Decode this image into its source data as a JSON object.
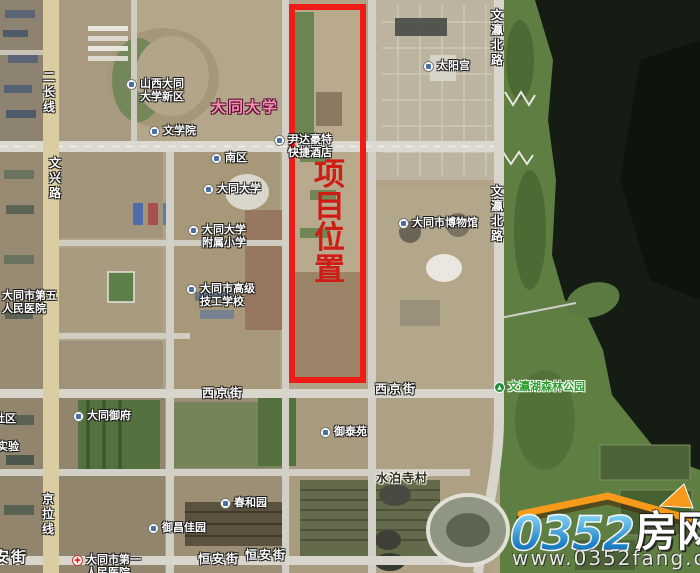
{
  "map": {
    "title": "大同 项目位置卫星图",
    "project_box": {
      "label": "项目位置",
      "border_color": "#ee1b17",
      "text_color": "#cf1d15"
    },
    "colors": {
      "land": "#b1a288",
      "water": "#141c14",
      "park": "#5f7e41",
      "road": "#d8d5cc",
      "main_road_tan": "#dbcda2",
      "box_red": "#ee1b17"
    },
    "labels": [
      {
        "name": "poi-shanxi-datong-univ-new-district",
        "kind": "poi",
        "icon": "building",
        "x": 126,
        "y": 78,
        "lines": [
          "山西大同",
          "大学新区"
        ]
      },
      {
        "name": "area-label-datong-university",
        "kind": "area",
        "x": 211,
        "y": 99,
        "lines": [
          "大同大学"
        ]
      },
      {
        "name": "poi-school-of-liberal-arts",
        "kind": "poi",
        "icon": "building",
        "x": 149,
        "y": 125,
        "lines": [
          "文学院"
        ]
      },
      {
        "name": "poi-south-campus",
        "kind": "poi",
        "icon": "building",
        "x": 211,
        "y": 152,
        "lines": [
          "南区"
        ]
      },
      {
        "name": "poi-datong-university",
        "kind": "poi",
        "icon": "building",
        "x": 203,
        "y": 183,
        "lines": [
          "大同大学"
        ]
      },
      {
        "name": "poi-affiliated-primary-school",
        "kind": "poi",
        "icon": "building",
        "x": 188,
        "y": 224,
        "lines": [
          "大同大学",
          "附属小学"
        ]
      },
      {
        "name": "label-fifth-peoples-hospital",
        "kind": "plain",
        "x": 2,
        "y": 290,
        "lines": [
          "大同市第五",
          "人民医院"
        ]
      },
      {
        "name": "poi-senior-technical-school",
        "kind": "poi",
        "icon": "building",
        "x": 186,
        "y": 283,
        "lines": [
          "大同市高级",
          "技工学校"
        ]
      },
      {
        "name": "poi-yindahaote-express-hotel",
        "kind": "poi",
        "icon": "building",
        "x": 274,
        "y": 134,
        "lines": [
          "尹达豪特",
          "快捷酒店"
        ]
      },
      {
        "name": "poi-sun-palace",
        "kind": "poi",
        "icon": "building",
        "x": 423,
        "y": 60,
        "lines": [
          "太阳宫"
        ]
      },
      {
        "name": "poi-datong-museum",
        "kind": "poi",
        "icon": "building",
        "x": 398,
        "y": 217,
        "lines": [
          "大同市博物馆"
        ]
      },
      {
        "name": "road-wenying-north-road-upper",
        "kind": "road-v",
        "x": 491,
        "y": 8,
        "lines": [
          "文瀛北路"
        ]
      },
      {
        "name": "road-wenying-north-road-lower",
        "kind": "road-v",
        "x": 491,
        "y": 184,
        "lines": [
          "文瀛北路"
        ]
      },
      {
        "name": "road-erchang-line",
        "kind": "road-v",
        "x": 43,
        "y": 70,
        "lines": [
          "二长线"
        ]
      },
      {
        "name": "road-wenxing-road",
        "kind": "road-v",
        "x": 49,
        "y": 156,
        "lines": [
          "文兴路"
        ]
      },
      {
        "name": "road-jingla-line",
        "kind": "road-v",
        "x": 42,
        "y": 492,
        "lines": [
          "京拉线"
        ]
      },
      {
        "name": "road-xijing-street-west",
        "kind": "road-h",
        "x": 202,
        "y": 386,
        "lines": [
          "西京街"
        ]
      },
      {
        "name": "road-xijing-street-east",
        "kind": "road-h",
        "x": 375,
        "y": 382,
        "lines": [
          "西京街"
        ]
      },
      {
        "name": "poi-wenyinghu-forest-park",
        "kind": "park",
        "icon": "tree",
        "x": 494,
        "y": 381,
        "lines": [
          "文瀛湖森林公园"
        ]
      },
      {
        "name": "poi-datong-yufu",
        "kind": "poi",
        "icon": "building",
        "x": 73,
        "y": 410,
        "lines": [
          "大同御府"
        ]
      },
      {
        "name": "label-shequ-partial",
        "kind": "plain",
        "x": -6,
        "y": 413,
        "lines": [
          "社区"
        ]
      },
      {
        "name": "label-shiyan-partial",
        "kind": "plain",
        "x": -3,
        "y": 441,
        "lines": [
          "实验"
        ]
      },
      {
        "name": "poi-yutaiyuan",
        "kind": "poi",
        "icon": "building",
        "x": 320,
        "y": 426,
        "lines": [
          "御泰苑"
        ]
      },
      {
        "name": "label-shuiposi-village",
        "kind": "village",
        "x": 376,
        "y": 471,
        "lines": [
          "水泊寺村"
        ]
      },
      {
        "name": "poi-chunheyuan",
        "kind": "poi",
        "icon": "building",
        "x": 220,
        "y": 497,
        "lines": [
          "春和园"
        ]
      },
      {
        "name": "poi-yuchang-jiayuan",
        "kind": "poi",
        "icon": "building",
        "x": 148,
        "y": 522,
        "lines": [
          "御昌佳园"
        ]
      },
      {
        "name": "road-hengan-street-center",
        "kind": "road-h",
        "x": 198,
        "y": 552,
        "lines": [
          "恒安街"
        ]
      },
      {
        "name": "road-hengan-street-east",
        "kind": "road-h",
        "x": 245,
        "y": 548,
        "lines": [
          "恒安街"
        ]
      },
      {
        "name": "road-hengan-street-west-partial",
        "kind": "road-h-lg",
        "x": -6,
        "y": 549,
        "lines": [
          "安街"
        ]
      },
      {
        "name": "poi-first-peoples-hospital",
        "kind": "poi",
        "icon": "hospital",
        "x": 72,
        "y": 554,
        "lines": [
          "大同市第一",
          "人民医院"
        ]
      }
    ]
  },
  "watermark": {
    "number": "0352",
    "cn": "房网",
    "url": "www.0352fang.com",
    "accent": "#f79a1b",
    "number_color": "#2a8fd0"
  }
}
